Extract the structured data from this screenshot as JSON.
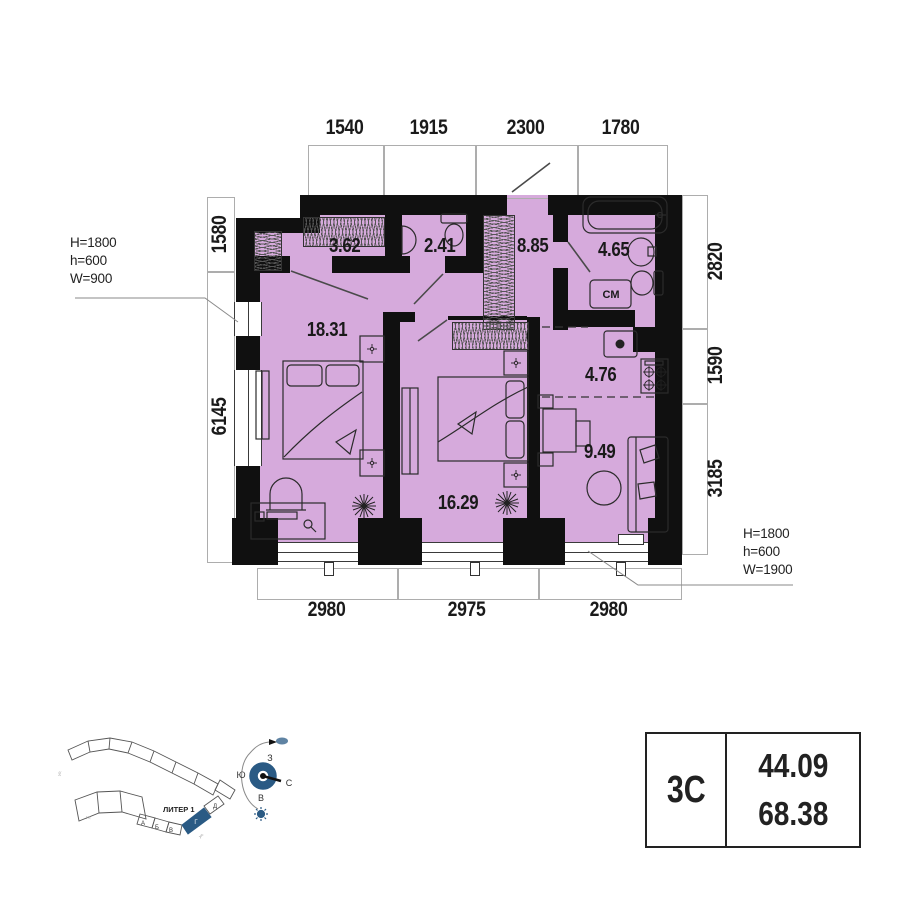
{
  "apartment": {
    "type_label": "3С",
    "areas": {
      "living": "44.09",
      "total": "68.38"
    }
  },
  "rooms": [
    {
      "name": "closet",
      "area": "3.62"
    },
    {
      "name": "wc",
      "area": "2.41"
    },
    {
      "name": "hallway",
      "area": "8.85"
    },
    {
      "name": "bathroom",
      "area": "4.65"
    },
    {
      "name": "bedroom-1",
      "area": "18.31"
    },
    {
      "name": "kitchen",
      "area": "4.76"
    },
    {
      "name": "living-zone",
      "area": "9.49"
    },
    {
      "name": "bedroom-2",
      "area": "16.29"
    }
  ],
  "labels": {
    "washing_machine": "СМ"
  },
  "dimensions": {
    "top": [
      "1540",
      "1915",
      "2300",
      "1780"
    ],
    "left": [
      "1580",
      "6145"
    ],
    "right": [
      "2820",
      "1590",
      "3185"
    ],
    "bottom": [
      "2980",
      "2975",
      "2980"
    ]
  },
  "window_annotations": {
    "left": [
      "H=1800",
      "h=600",
      "W=900"
    ],
    "bottom_right": [
      "H=1800",
      "h=600",
      "W=1900"
    ]
  },
  "site_plan": {
    "building_label": "ЛИТЕР 1",
    "blocks": [
      "А",
      "Б",
      "В",
      "Г",
      "Д"
    ],
    "highlighted_block": "Г",
    "streets": [
      "ул.",
      "ул.",
      "ул."
    ]
  },
  "compass": {
    "west": "З",
    "south": "Ю",
    "north": "С",
    "east": "В"
  },
  "colors": {
    "room_fill": "#d6aadc",
    "wall": "#101010",
    "accent_blue": "#2a5a84"
  }
}
